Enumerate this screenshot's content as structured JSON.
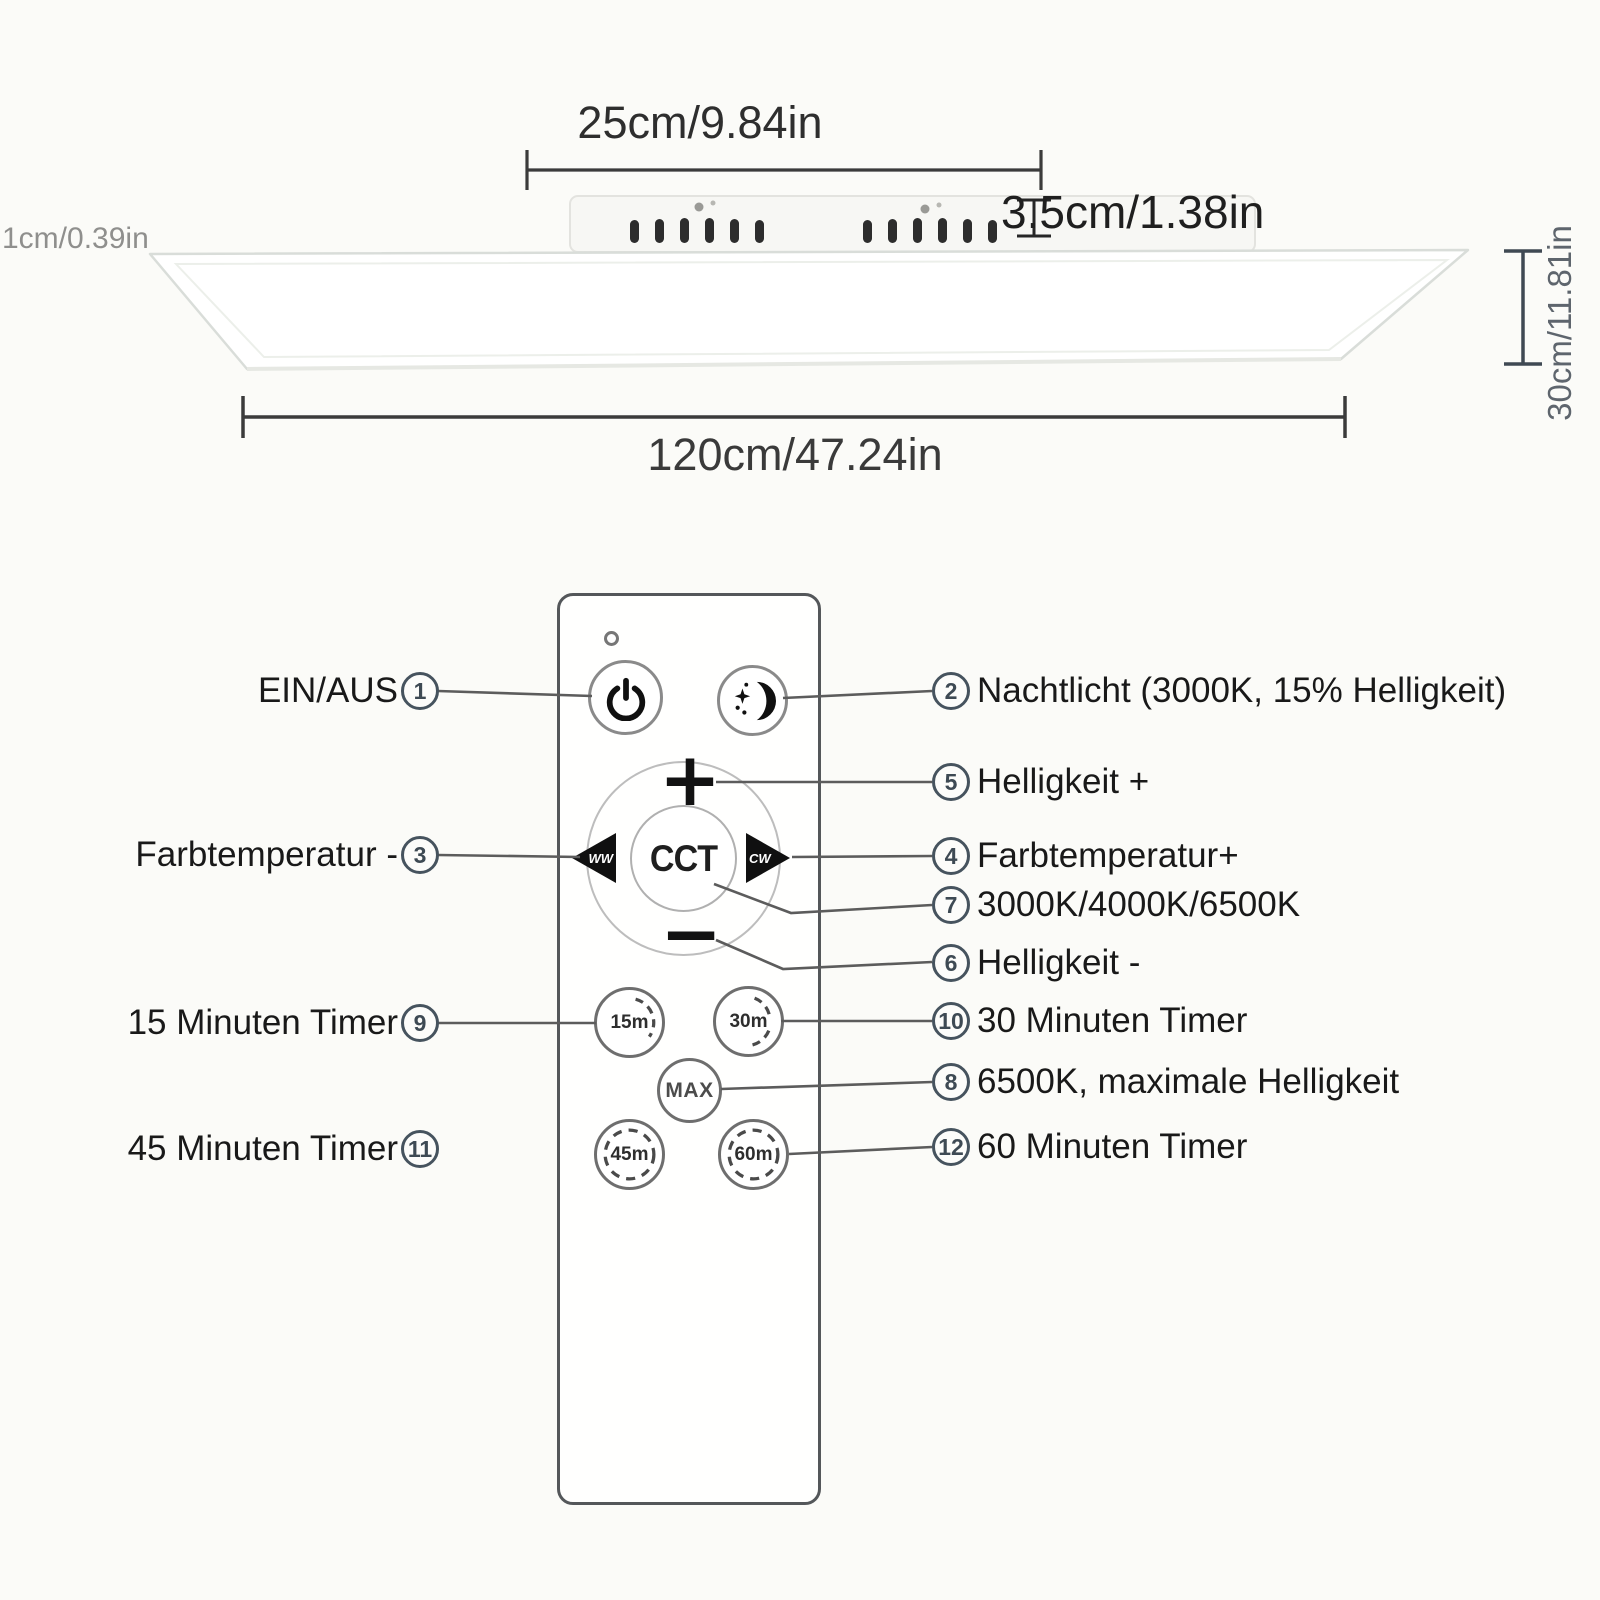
{
  "dimensions": {
    "bracket_width": "25cm/9.84in",
    "bracket_height": "3.5cm/1.38in",
    "panel_edge": "1cm/0.39in",
    "panel_depth": "30cm/11.81in",
    "panel_width": "120cm/47.24in"
  },
  "remote": {
    "plus_label": "+",
    "minus_label": "−",
    "ww_label": "WW",
    "cw_label": "CW",
    "cct_label": "CCT",
    "max_label": "MAX",
    "timer_15": "15m",
    "timer_30": "30m",
    "timer_45": "45m",
    "timer_60": "60m"
  },
  "callouts": {
    "left": [
      {
        "num": "1",
        "label": "EIN/AUS"
      },
      {
        "num": "3",
        "label": "Farbtemperatur -"
      },
      {
        "num": "9",
        "label": "15 Minuten Timer"
      },
      {
        "num": "11",
        "label": "45 Minuten Timer"
      }
    ],
    "right": [
      {
        "num": "2",
        "label": "Nachtlicht (3000K, 15% Helligkeit)"
      },
      {
        "num": "5",
        "label": "Helligkeit +"
      },
      {
        "num": "4",
        "label": "Farbtemperatur+"
      },
      {
        "num": "7",
        "label": "3000K/4000K/6500K"
      },
      {
        "num": "6",
        "label": "Helligkeit -"
      },
      {
        "num": "10",
        "label": "30 Minuten Timer"
      },
      {
        "num": "8",
        "label": "6500K, maximale Helligkeit"
      },
      {
        "num": "12",
        "label": "60 Minuten Timer"
      }
    ]
  },
  "colors": {
    "dimension_line": "#3b3b3b",
    "muted_text": "#8f8f8d",
    "slate_text": "#5e656d",
    "callout_slate": "#46535e",
    "button_black": "#111111"
  }
}
